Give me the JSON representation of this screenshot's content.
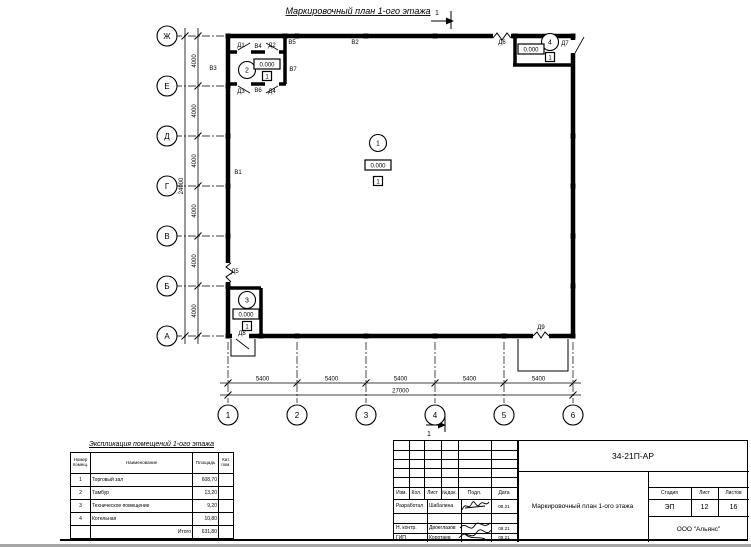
{
  "title": "Маркировочный план 1-ого этажа",
  "plan": {
    "section_mark_top": "1",
    "section_mark_bottom": "1",
    "axes_bottom": [
      {
        "label": "1",
        "x": 228
      },
      {
        "label": "2",
        "x": 297
      },
      {
        "label": "3",
        "x": 366
      },
      {
        "label": "4",
        "x": 435
      },
      {
        "label": "5",
        "x": 504
      },
      {
        "label": "6",
        "x": 573
      }
    ],
    "axes_left": [
      {
        "label": "Ж",
        "y": 36
      },
      {
        "label": "Е",
        "y": 86
      },
      {
        "label": "Д",
        "y": 136
      },
      {
        "label": "Г",
        "y": 186
      },
      {
        "label": "В",
        "y": 236
      },
      {
        "label": "Б",
        "y": 286
      },
      {
        "label": "А",
        "y": 336
      }
    ],
    "dim_bottom_segments": [
      "5400",
      "5400",
      "5400",
      "5400",
      "5400"
    ],
    "dim_bottom_total": "27000",
    "dim_left_segments": [
      "4000",
      "4000",
      "4000",
      "4000",
      "4000",
      "4000"
    ],
    "dim_left_total": "24000",
    "wall_labels": [
      {
        "text": "В1",
        "x": 238,
        "y": 174
      },
      {
        "text": "В2",
        "x": 355,
        "y": 44
      },
      {
        "text": "В3",
        "x": 213,
        "y": 70
      },
      {
        "text": "В4",
        "x": 258,
        "y": 48
      },
      {
        "text": "В5",
        "x": 292,
        "y": 44
      },
      {
        "text": "В6",
        "x": 258,
        "y": 92
      },
      {
        "text": "В7",
        "x": 293,
        "y": 71
      },
      {
        "text": "Д1",
        "x": 241,
        "y": 47
      },
      {
        "text": "Д2",
        "x": 272,
        "y": 47
      },
      {
        "text": "Д3",
        "x": 241,
        "y": 93
      },
      {
        "text": "Д4",
        "x": 272,
        "y": 93
      },
      {
        "text": "Д5",
        "x": 235,
        "y": 273
      },
      {
        "text": "Д6",
        "x": 502,
        "y": 44
      },
      {
        "text": "Д7",
        "x": 565,
        "y": 45
      },
      {
        "text": "Д8",
        "x": 242,
        "y": 335
      },
      {
        "text": "Д9",
        "x": 541,
        "y": 329
      }
    ],
    "rooms": [
      {
        "number": "1",
        "elevation": "0.000",
        "floor_type": "1",
        "cx": 378,
        "cy": 143,
        "ex": 378,
        "ey": 165,
        "fx": 378,
        "fy": 181
      },
      {
        "number": "2",
        "elevation": "0.000",
        "floor_type": "1",
        "cx": 247,
        "cy": 70,
        "ex": 267,
        "ey": 64,
        "fx": 267,
        "fy": 76
      },
      {
        "number": "3",
        "elevation": "0.000",
        "floor_type": "1",
        "cx": 247,
        "cy": 300,
        "ex": 246,
        "ey": 314,
        "fx": 247,
        "fy": 326
      },
      {
        "number": "4",
        "elevation": "0.000",
        "floor_type": "1",
        "cx": 550,
        "cy": 42,
        "ex": 531,
        "ey": 49,
        "fx": 550,
        "fy": 57
      }
    ]
  },
  "explication": {
    "title": "Экспликация помещений 1-ого этажа",
    "headers": [
      "Номер помещ.",
      "Наименование",
      "Площадь",
      "Кат. пом."
    ],
    "rows": [
      {
        "num": "1",
        "name": "Торговый зал",
        "area": "608,70",
        "cat": ""
      },
      {
        "num": "2",
        "name": "Тамбур",
        "area": "13,20",
        "cat": ""
      },
      {
        "num": "3",
        "name": "Техническое помещение",
        "area": "9,20",
        "cat": ""
      },
      {
        "num": "4",
        "name": "Котельная",
        "area": "10,80",
        "cat": ""
      }
    ],
    "total_label": "Итого",
    "total_value": "631,80"
  },
  "titleblock": {
    "doc_number": "34-21П-АР",
    "header_cols": [
      "Изм.",
      "Кол.",
      "Лист",
      "№док.",
      "Подл.",
      "Дата"
    ],
    "rows": [
      {
        "role": "Разработал",
        "name": "Шабалина",
        "date": "08.21"
      },
      {
        "role": "Н. контр.",
        "name": "Двоеглазов",
        "date": "08.21"
      },
      {
        "role": "ГИП",
        "name": "Коротаев",
        "date": "08.21"
      }
    ],
    "stage_label": "Стадия",
    "sheet_label": "Лист",
    "sheets_label": "Листов",
    "stage": "ЭП",
    "sheet": "12",
    "sheets": "16",
    "drawing_name": "Маркировочный план 1-ого этажа",
    "organization": "ООО \"Альянс\""
  }
}
